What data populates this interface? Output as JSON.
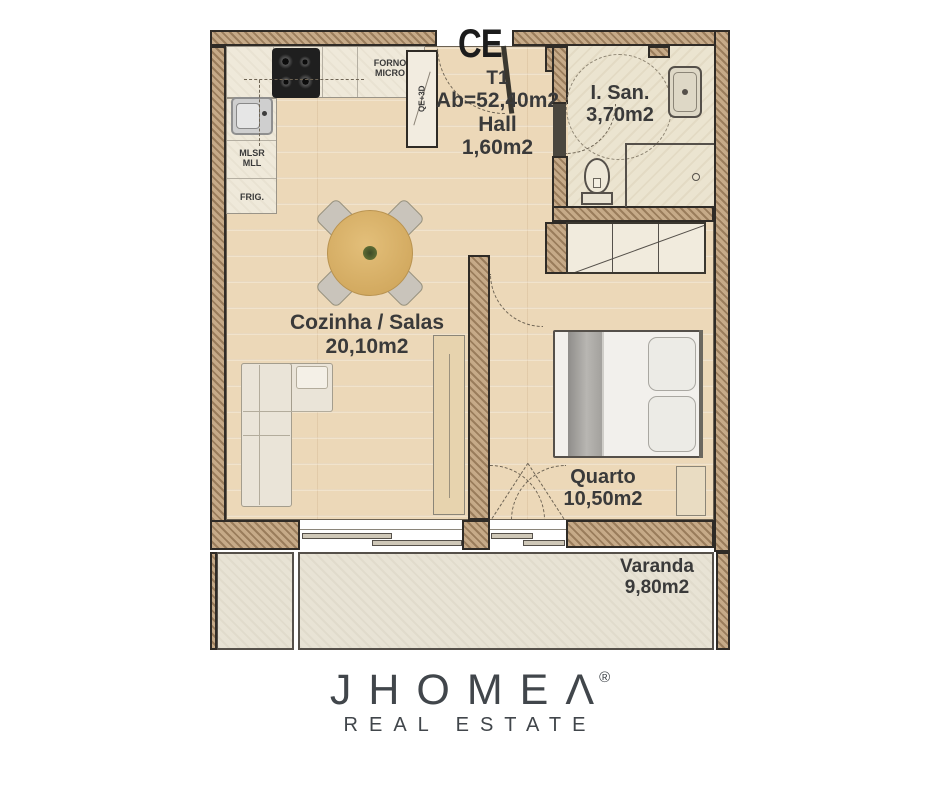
{
  "plan": {
    "entrance": {
      "code": "CE"
    },
    "unit": {
      "type": "T1",
      "gross_area": "Ab=52,40m2"
    },
    "rooms": [
      {
        "name": "Hall",
        "area": "1,60m2"
      },
      {
        "name": "I. San.",
        "area": "3,70m2"
      },
      {
        "name": "Cozinha / Salas",
        "area": "20,10m2"
      },
      {
        "name": "Quarto",
        "area": "10,50m2"
      },
      {
        "name": "Varanda",
        "area": "9,80m2"
      }
    ],
    "appliances": {
      "oven_line1": "FORNO",
      "oven_line2": "MICRO",
      "laundry_line1": "MLSR",
      "laundry_line2": "MLL",
      "fridge": "FRIG.",
      "shaft": "QE+3D"
    }
  },
  "branding": {
    "wordmark": "JHOMEΛ",
    "registered": "®",
    "tagline": "REAL ESTATE"
  },
  "colors": {
    "wall_hatch_base": "#c6aa88",
    "wall_hatch_line": "#9a7d5c",
    "wall_outline": "#2f2b26",
    "wood_floor": "#ecd8b8",
    "counter": "#efe9da",
    "bath_floor": "#ebe4d0",
    "balcony_floor": "#e8e3d5",
    "label_text": "#3a3a3a",
    "brand_text": "#41464b"
  }
}
